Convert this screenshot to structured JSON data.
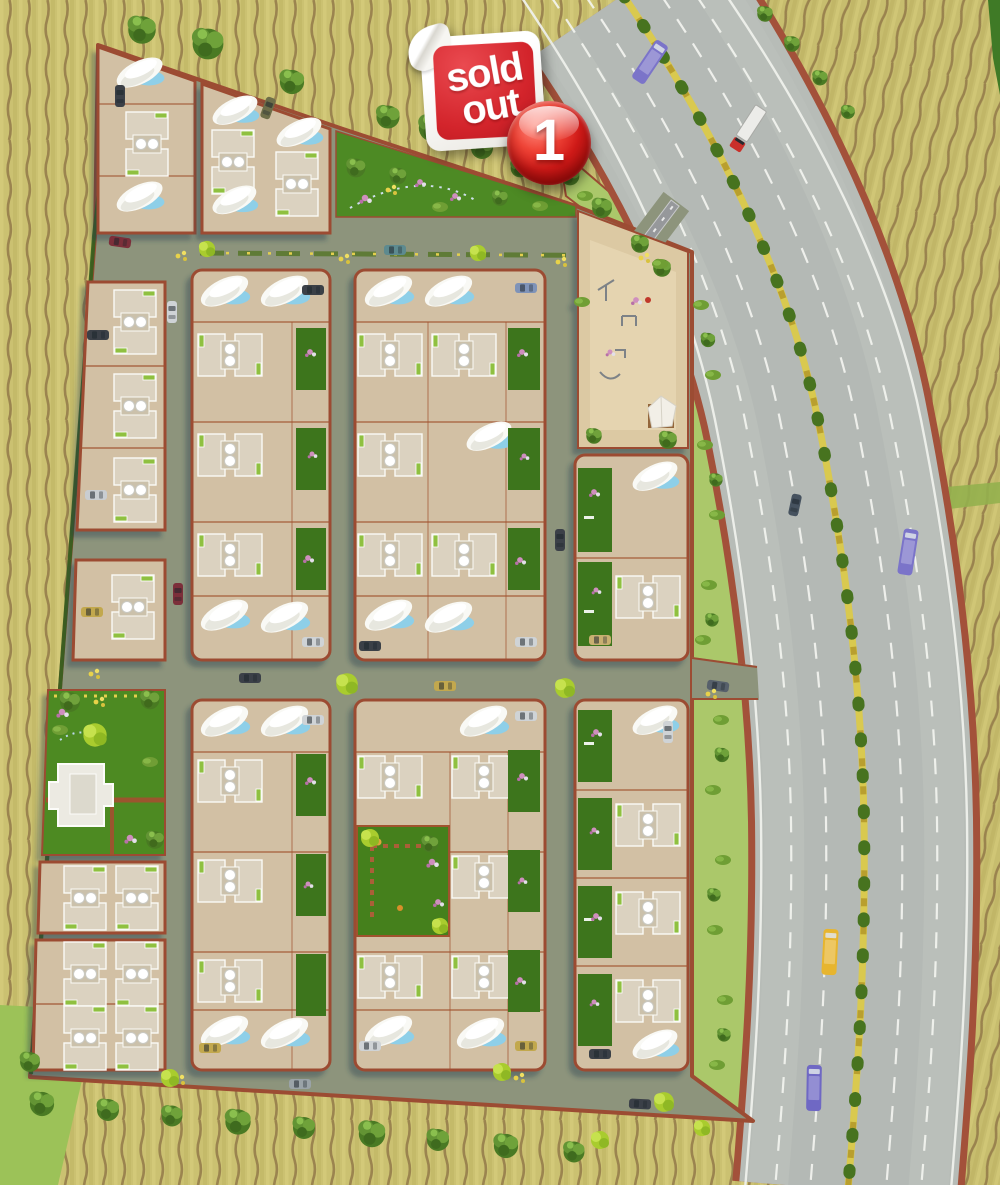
{
  "badges": {
    "sold_out": {
      "line1": "sold",
      "line2": "out"
    },
    "marker": {
      "label": "1"
    }
  },
  "palette": {
    "farmland": "#cbc171",
    "farmland_rows": "#8f7446",
    "internal_road": "#8d947c",
    "plot_fill": "#d2c0a4",
    "plot_border": "#9c4c33",
    "garden_green": "#3c741e",
    "park_green": "#4d8a24",
    "buffer_green": "#abc86a",
    "highway_asphalt": "#b7bcb7",
    "lane_marking": "#f2f4f0",
    "median_yellow": "#d9c94f",
    "shell_roof_white": "#f9f9f5",
    "pool_blue": "#8ecfe8",
    "sticker_red": "#d3242b",
    "marker_red": "#d01a18",
    "bus_purple": "#7b74c9",
    "bus_yellow": "#e7b52f",
    "truck_cab_red": "#c9302a"
  }
}
